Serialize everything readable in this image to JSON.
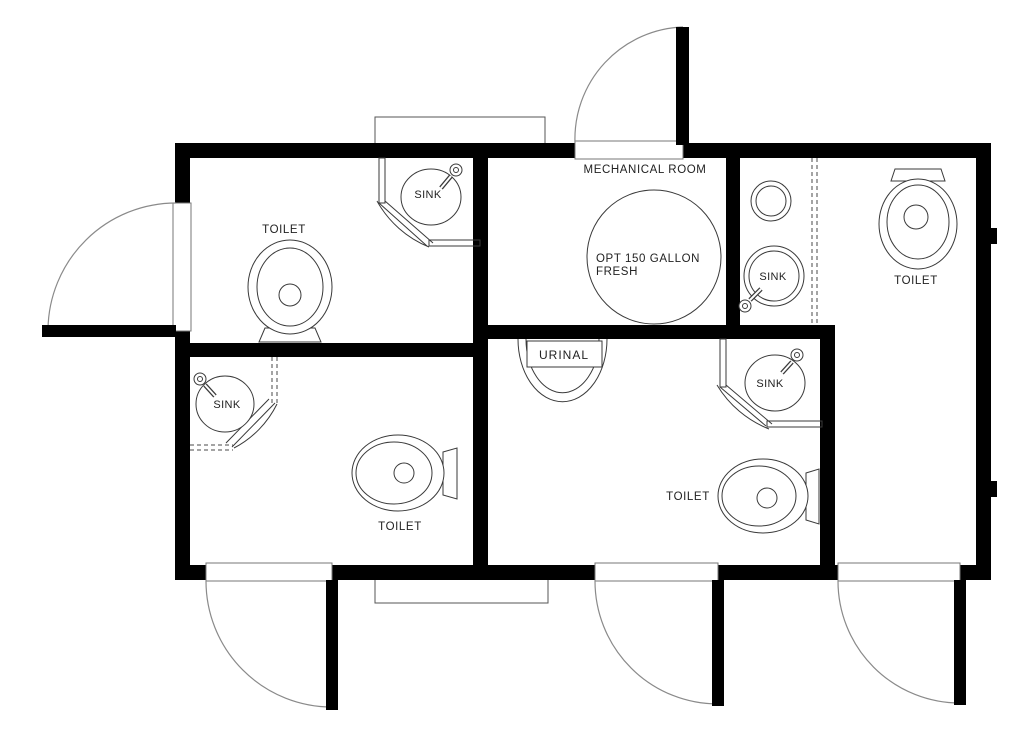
{
  "diagram": {
    "type": "restroom-trailer-floor-plan",
    "colors": {
      "wall": "#000000",
      "fixture_line": "#3a3a3a",
      "door_arc": "#8a8a8a",
      "background": "#ffffff",
      "text": "#222222"
    },
    "rooms": {
      "top_left_restroom": {
        "toilet_label": "TOILET",
        "sink_label": "SINK"
      },
      "bottom_left_restroom": {
        "toilet_label": "TOILET",
        "sink_label": "SINK"
      },
      "mechanical_room": {
        "name": "MECHANICAL ROOM",
        "tank_label_line1": "OPT 150 GALLON",
        "tank_label_line2": "FRESH"
      },
      "bottom_middle_restroom": {
        "urinal_label": "URINAL",
        "sink_label": "SINK",
        "toilet_label": "TOILET"
      },
      "right_restroom": {
        "sink_label": "SINK",
        "toilet_label": "TOILET"
      }
    }
  }
}
